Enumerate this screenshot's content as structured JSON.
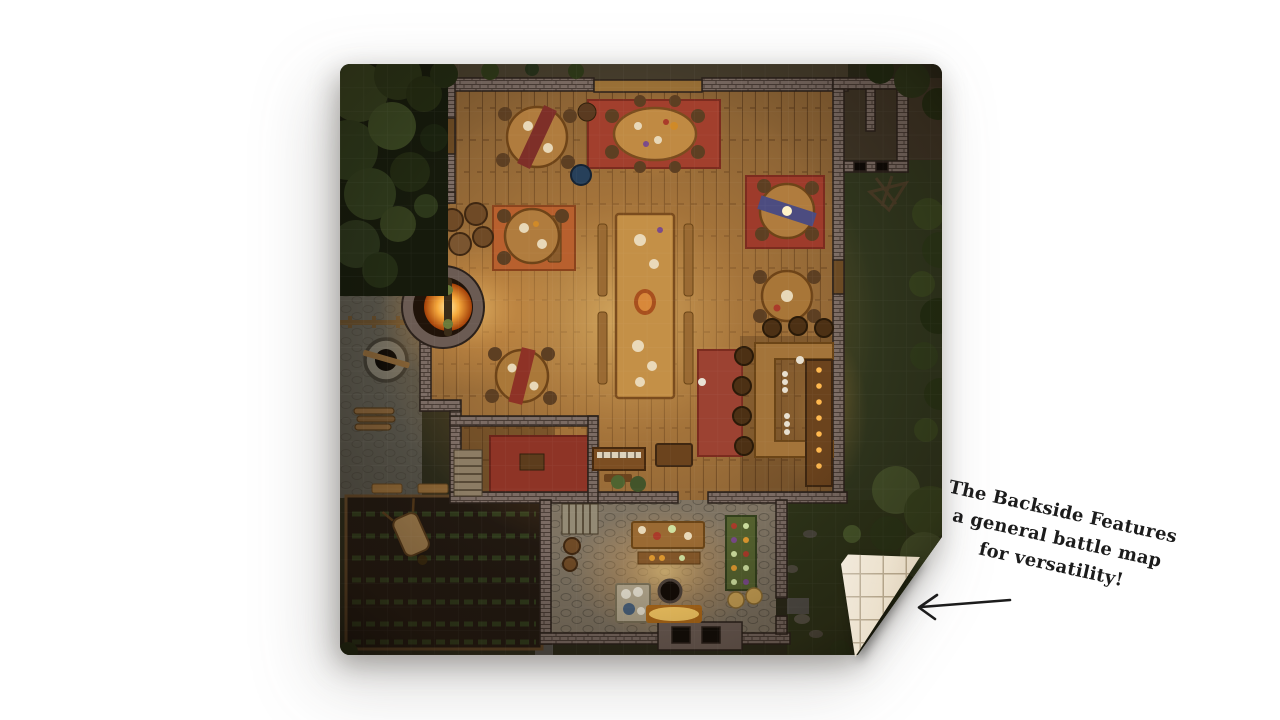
{
  "annotation": {
    "lines": [
      "The Backside Features",
      "a general battle map",
      "for versatility!"
    ]
  },
  "arrow": {
    "direction": "left",
    "points_to": "curled corner showing gridded backside"
  },
  "mat": {
    "front_side": "top-down fantasy tavern battle map with surrounding yard, garden and trees",
    "back_side": "blank parchment battle grid (square cells)"
  },
  "colors": {
    "page_bg": "#ffffff",
    "ink": "#1c1c1c",
    "parchment": "#ece1cd",
    "parchment_line": "#b3a48a",
    "wood_floor": "#8a6234",
    "glow_amber": "#ffd27a",
    "stone_wall": "#7b6b63",
    "rug_red": "#9e3b2b",
    "rug_orange": "#b8602e",
    "exterior_green": "#2e3419"
  }
}
